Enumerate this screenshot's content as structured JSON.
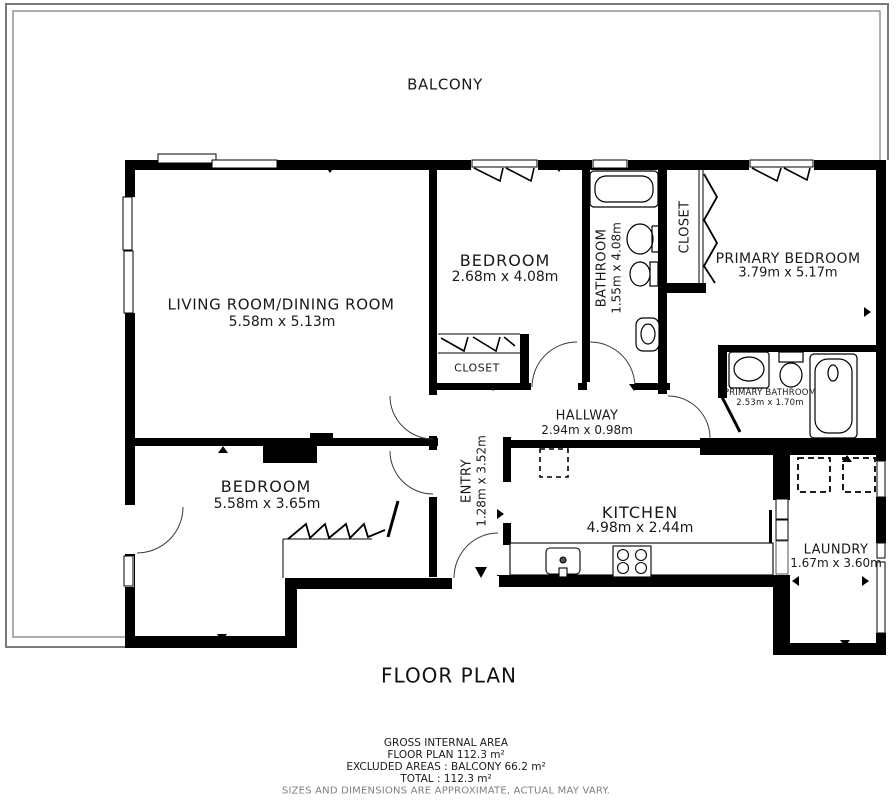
{
  "plan": {
    "balcony_label": "BALCONY",
    "title": "FLOOR PLAN",
    "rooms": {
      "living": {
        "name": "LIVING ROOM/DINING ROOM",
        "dims": "5.58m x 5.13m"
      },
      "bedroom_top": {
        "name": "BEDROOM",
        "dims": "2.68m x 4.08m"
      },
      "bathroom": {
        "name": "BATHROOM",
        "dims": "1.55m x 4.08m"
      },
      "closet_primary": {
        "name": "CLOSET"
      },
      "primary_bedroom": {
        "name": "PRIMARY BEDROOM",
        "dims": "3.79m x 5.17m"
      },
      "primary_bathroom": {
        "name": "PRIMARY BATHROOM",
        "dims": "2.53m x 1.70m"
      },
      "hallway": {
        "name": "HALLWAY",
        "dims": "2.94m x 0.98m"
      },
      "entry": {
        "name": "ENTRY",
        "dims": "1.28m x 3.52m"
      },
      "closet_bedroom": {
        "name": "CLOSET"
      },
      "bedroom_bottom": {
        "name": "BEDROOM",
        "dims": "5.58m x 3.65m"
      },
      "kitchen": {
        "name": "KITCHEN",
        "dims": "4.98m x 2.44m"
      },
      "laundry": {
        "name": "LAUNDRY",
        "dims": "1.67m x 3.60m"
      }
    },
    "footer": {
      "line1": "GROSS INTERNAL AREA",
      "line2": "FLOOR PLAN 112.3 m²",
      "line3": "EXCLUDED AREAS :  BALCONY 66.2 m²",
      "line4": "TOTAL :  112.3 m²",
      "disclaimer": "SIZES AND DIMENSIONS ARE APPROXIMATE, ACTUAL MAY VARY."
    },
    "colors": {
      "wall": "#000000",
      "balcony_line": "#7a7a7a",
      "disclaimer_text": "#808080"
    }
  }
}
